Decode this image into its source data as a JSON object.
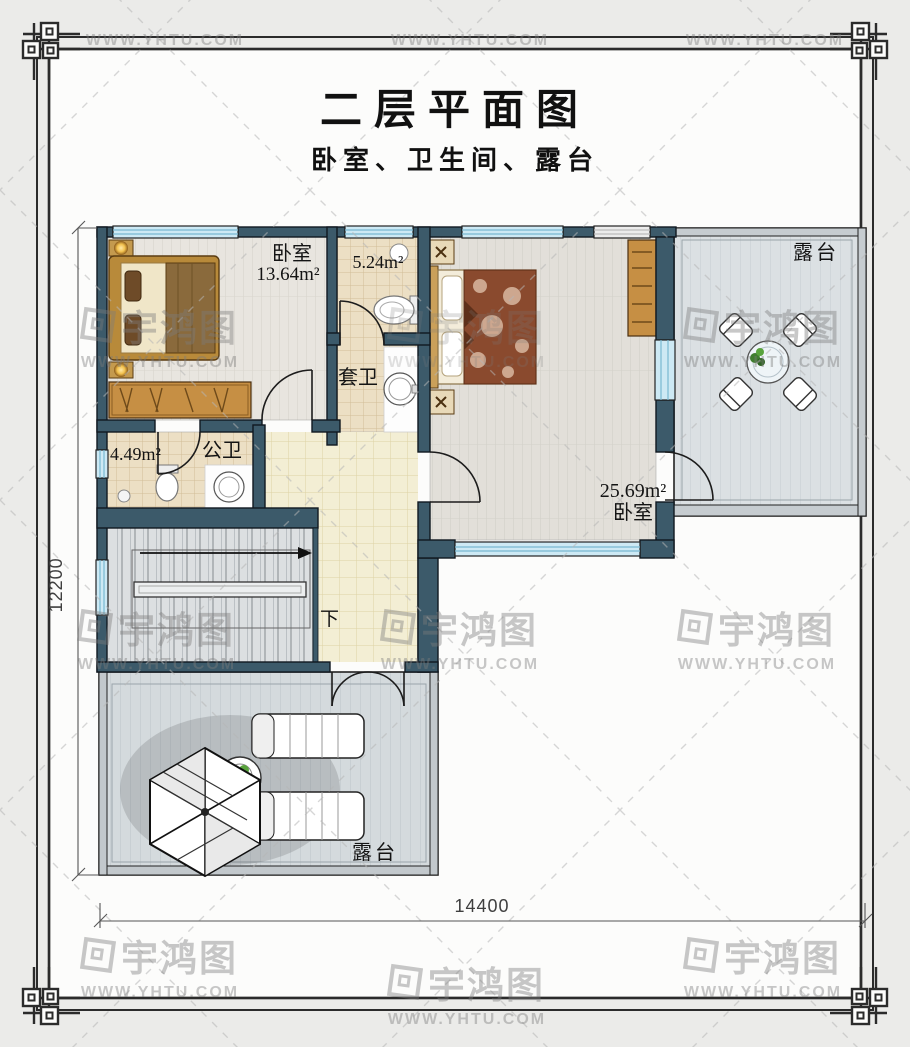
{
  "title": {
    "text": "二层平面图",
    "subtitle": "卧室、卫生间、露台"
  },
  "watermark": {
    "brand": "宇鸿图",
    "url": "WWW.YHTU.COM"
  },
  "rooms": {
    "bedroom1": {
      "name": "卧室",
      "area": "13.64m²"
    },
    "ensuite_bath": {
      "name": "套卫",
      "area": "5.24m²"
    },
    "public_bath": {
      "name": "公卫",
      "area": "4.49m²"
    },
    "bedroom2": {
      "name": "卧室",
      "area": "25.69m²"
    },
    "terrace_right": {
      "name": "露台"
    },
    "terrace_bottom": {
      "name": "露台"
    },
    "stairs": {
      "down_label": "下"
    }
  },
  "dimensions": {
    "total_width_mm": "14400",
    "total_depth_mm": "12200"
  },
  "colors": {
    "wall": "#3c5a6a",
    "window": "#cde9f4",
    "hall_floor": "#f3eed4",
    "tile_floor": "#ecdfc4",
    "terrace_floor": "#d4dadd",
    "accent_wood": "#c68f44"
  }
}
